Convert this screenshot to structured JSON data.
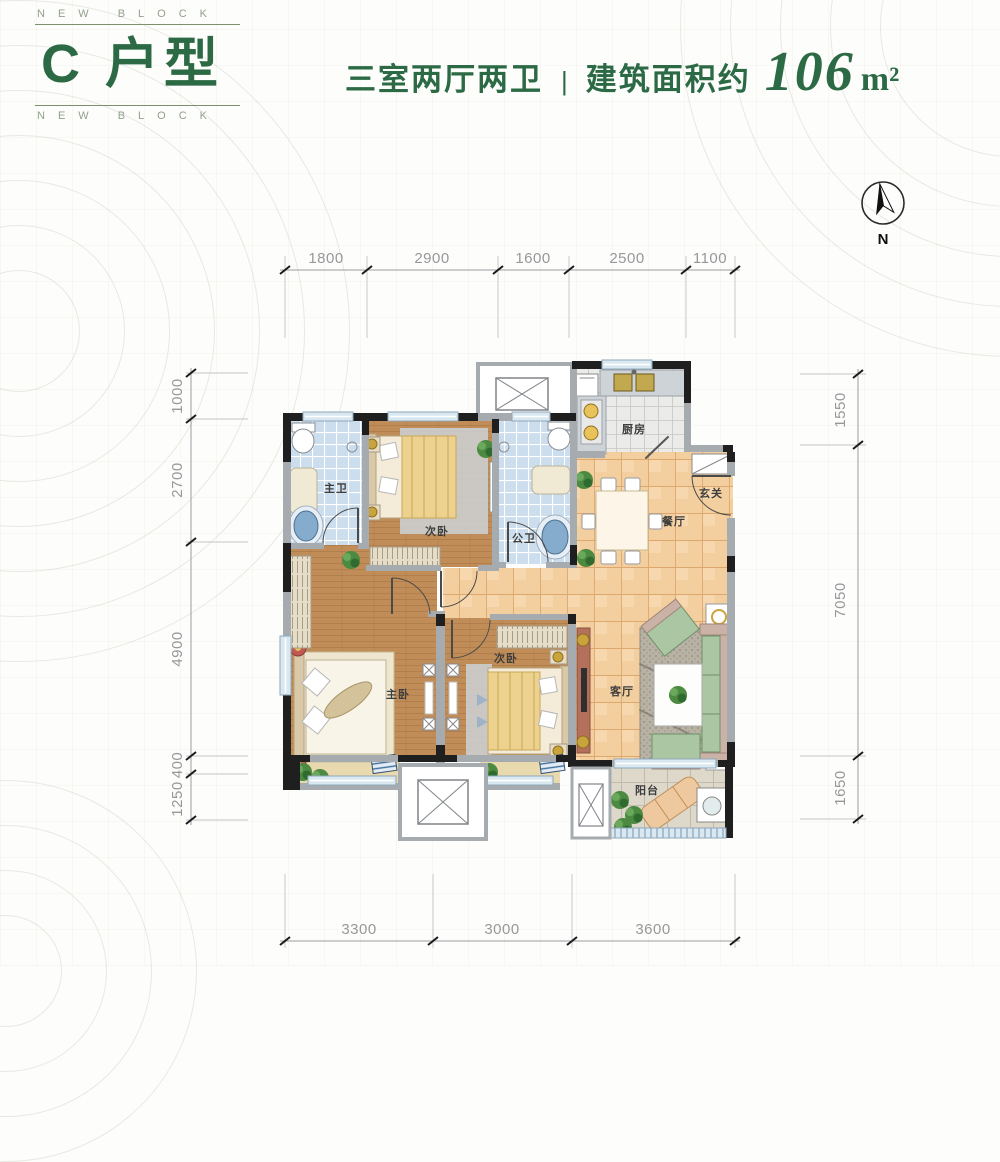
{
  "header": {
    "brand_top": "NEW BLOCK",
    "brand_bottom": "NEW BLOCK",
    "unit_title": "C 户型",
    "layout": "三室两厅两卫",
    "separator": "|",
    "area_label": "建筑面积约",
    "area_value": "106",
    "area_unit": "m²",
    "accent_color": "#2b6a45"
  },
  "compass": {
    "north_label": "N"
  },
  "floor_plan": {
    "rooms": [
      {
        "id": "master-bath",
        "label": "主卫"
      },
      {
        "id": "bedroom-2",
        "label": "次卧"
      },
      {
        "id": "public-bath",
        "label": "公卫"
      },
      {
        "id": "kitchen",
        "label": "厨房"
      },
      {
        "id": "entry",
        "label": "玄关"
      },
      {
        "id": "dining",
        "label": "餐厅"
      },
      {
        "id": "master-bedroom",
        "label": "主卧"
      },
      {
        "id": "bedroom-3",
        "label": "次卧"
      },
      {
        "id": "living",
        "label": "客厅"
      },
      {
        "id": "balcony",
        "label": "阳台"
      }
    ],
    "dimensions": {
      "top": [
        "1800",
        "2900",
        "1600",
        "2500",
        "1100"
      ],
      "left": [
        "1000",
        "2700",
        "4900",
        "400",
        "1250"
      ],
      "right": [
        "1550",
        "7050",
        "1650"
      ],
      "bottom": [
        "3300",
        "3000",
        "3600"
      ]
    }
  }
}
